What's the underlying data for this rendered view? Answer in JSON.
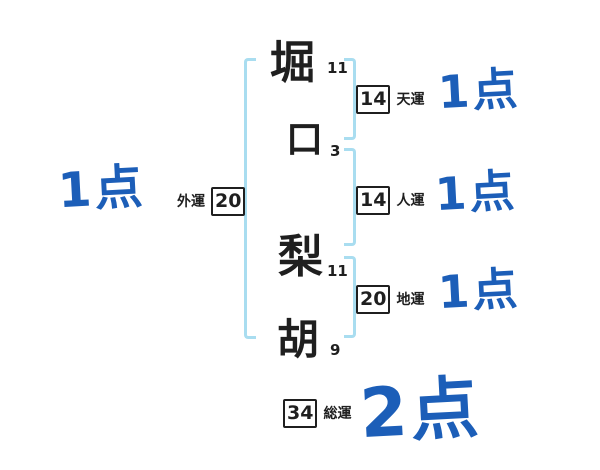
{
  "colors": {
    "background": "#ffffff",
    "ink": "#1f1f1f",
    "bracket_blue": "#a9ddf0",
    "score_blue": "#1c5eb8"
  },
  "name": {
    "characters": [
      {
        "char": "堀",
        "strokes": "11"
      },
      {
        "char": "口",
        "strokes": "3"
      },
      {
        "char": "梨",
        "strokes": "11"
      },
      {
        "char": "胡",
        "strokes": "9"
      }
    ]
  },
  "fortunes": [
    {
      "id": "heaven",
      "label": "天運",
      "value": "14",
      "score": "1点"
    },
    {
      "id": "person",
      "label": "人運",
      "value": "14",
      "score": "1点"
    },
    {
      "id": "earth",
      "label": "地運",
      "value": "20",
      "score": "1点"
    },
    {
      "id": "outer",
      "label": "外運",
      "value": "20",
      "score": "1点"
    },
    {
      "id": "total",
      "label": "総運",
      "value": "34",
      "score": "2点"
    }
  ]
}
